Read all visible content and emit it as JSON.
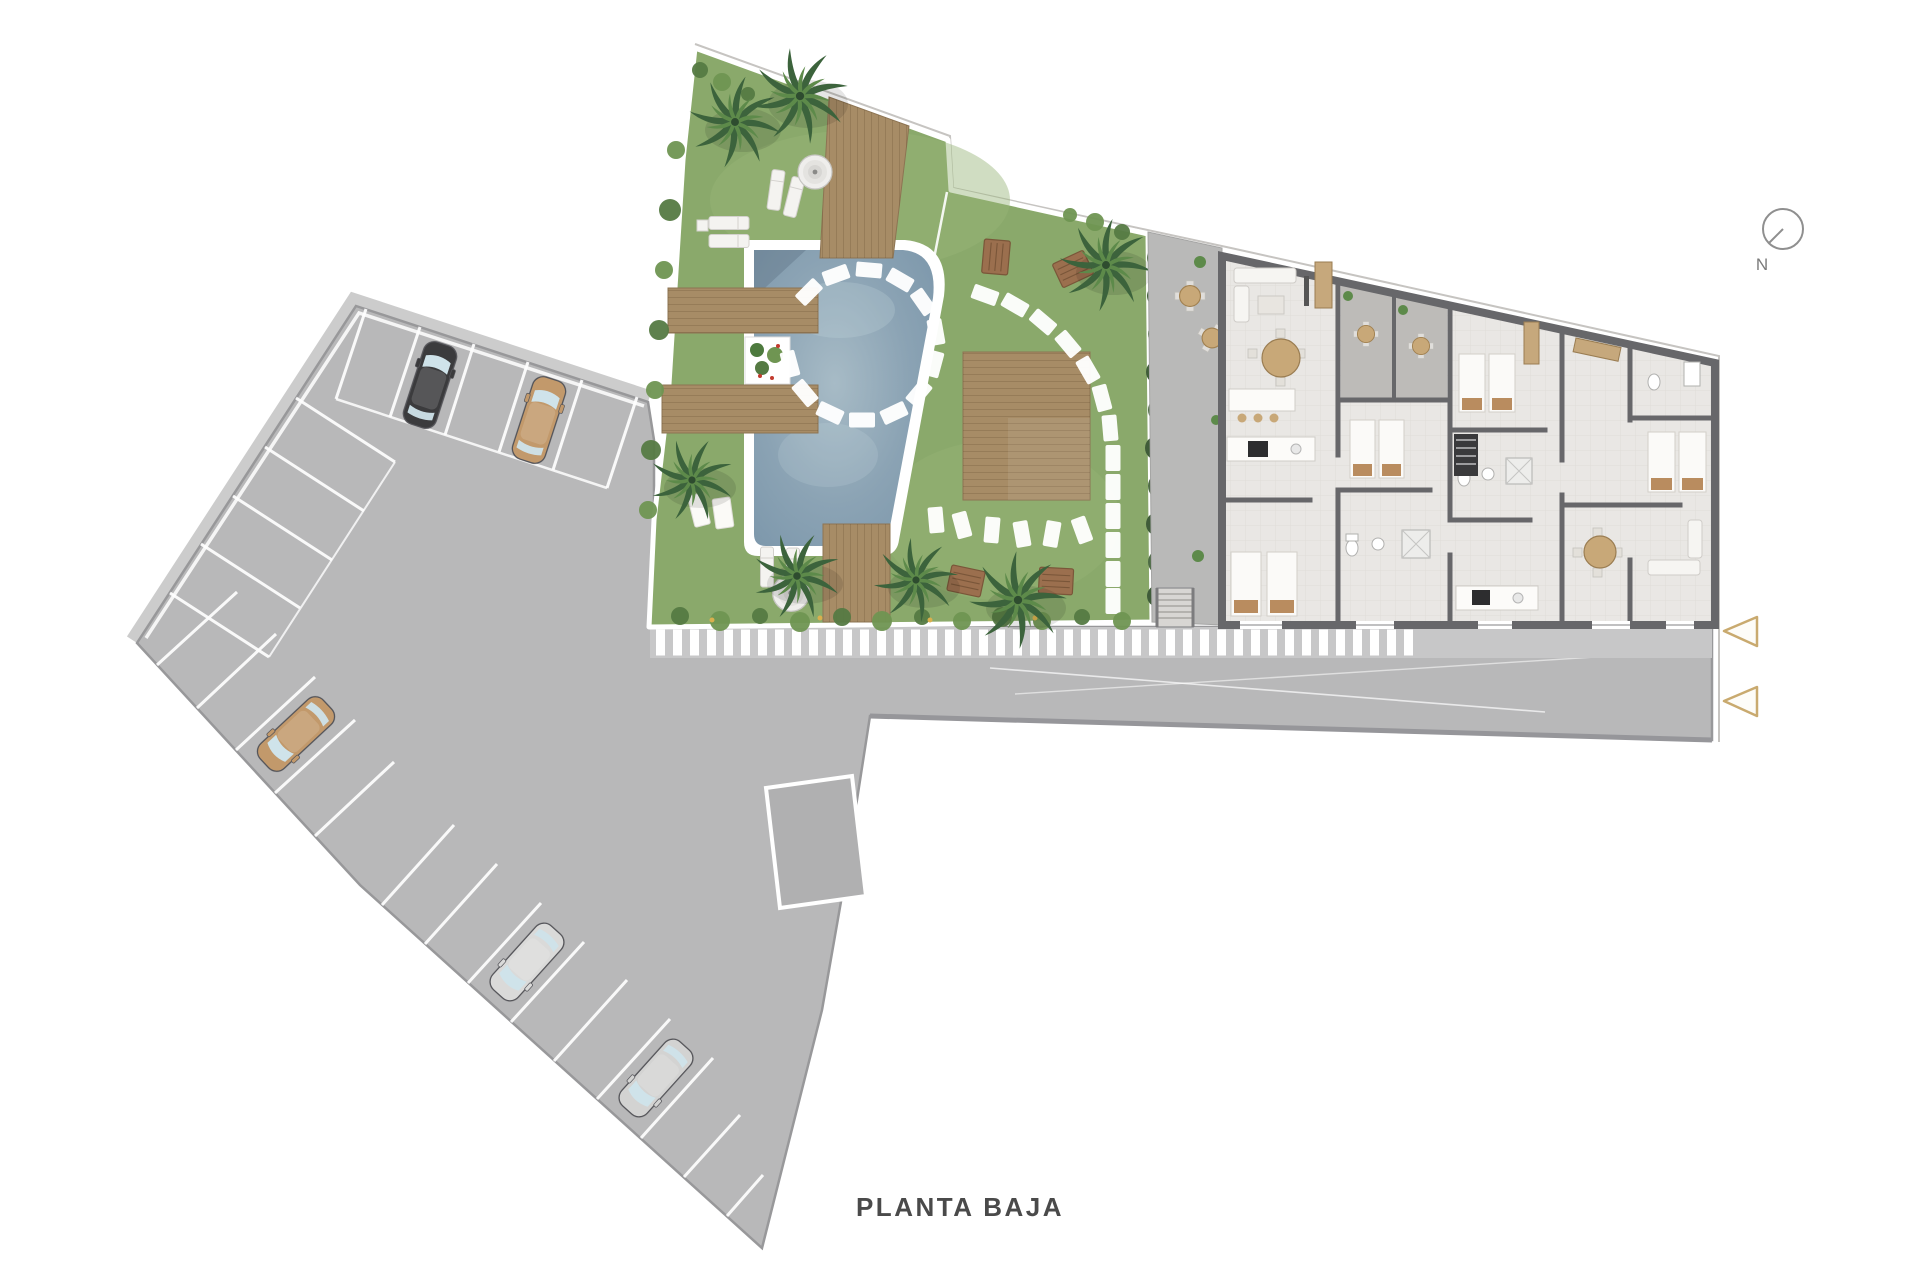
{
  "title": {
    "text": "PLANTA BAJA"
  },
  "compass": {
    "label": "N"
  },
  "palette": {
    "lawn": "#8aa96b",
    "lawn_light": "#97b478",
    "pool": "#8ba3b4",
    "pool_light": "#a7bbc6",
    "deck": "#a78c66",
    "deck_edge": "#8d7453",
    "pavement": "#b8b8b9",
    "walkway": "#c7c7c8",
    "building_floor": "#e9e7e4",
    "wall": "#67676a",
    "terrace": "#bdbbb8",
    "hedge": "#4d6b45",
    "palm": "#3c633c",
    "palm_light": "#5d8a4a",
    "accent_wood": "#c8a878",
    "bench": "#9b6f4e",
    "marker_outline": "#c9aa6f",
    "title_text": "#4a4a4a",
    "stripe": "#ffffff"
  },
  "cars": [
    {
      "id": "car-1",
      "color_name": "black",
      "color": "#3b3b3d",
      "row": "upper"
    },
    {
      "id": "car-2",
      "color_name": "tan",
      "color": "#c2996b",
      "row": "upper"
    },
    {
      "id": "car-3",
      "color_name": "tan",
      "color": "#c2996b",
      "row": "lower"
    },
    {
      "id": "car-4",
      "color_name": "silver",
      "color": "#dadad9",
      "row": "lower"
    },
    {
      "id": "car-5",
      "color_name": "silver",
      "color": "#d3d3d2",
      "row": "lower"
    }
  ],
  "markers": {
    "entry_arrows": {
      "count": 2,
      "direction": "left"
    }
  }
}
